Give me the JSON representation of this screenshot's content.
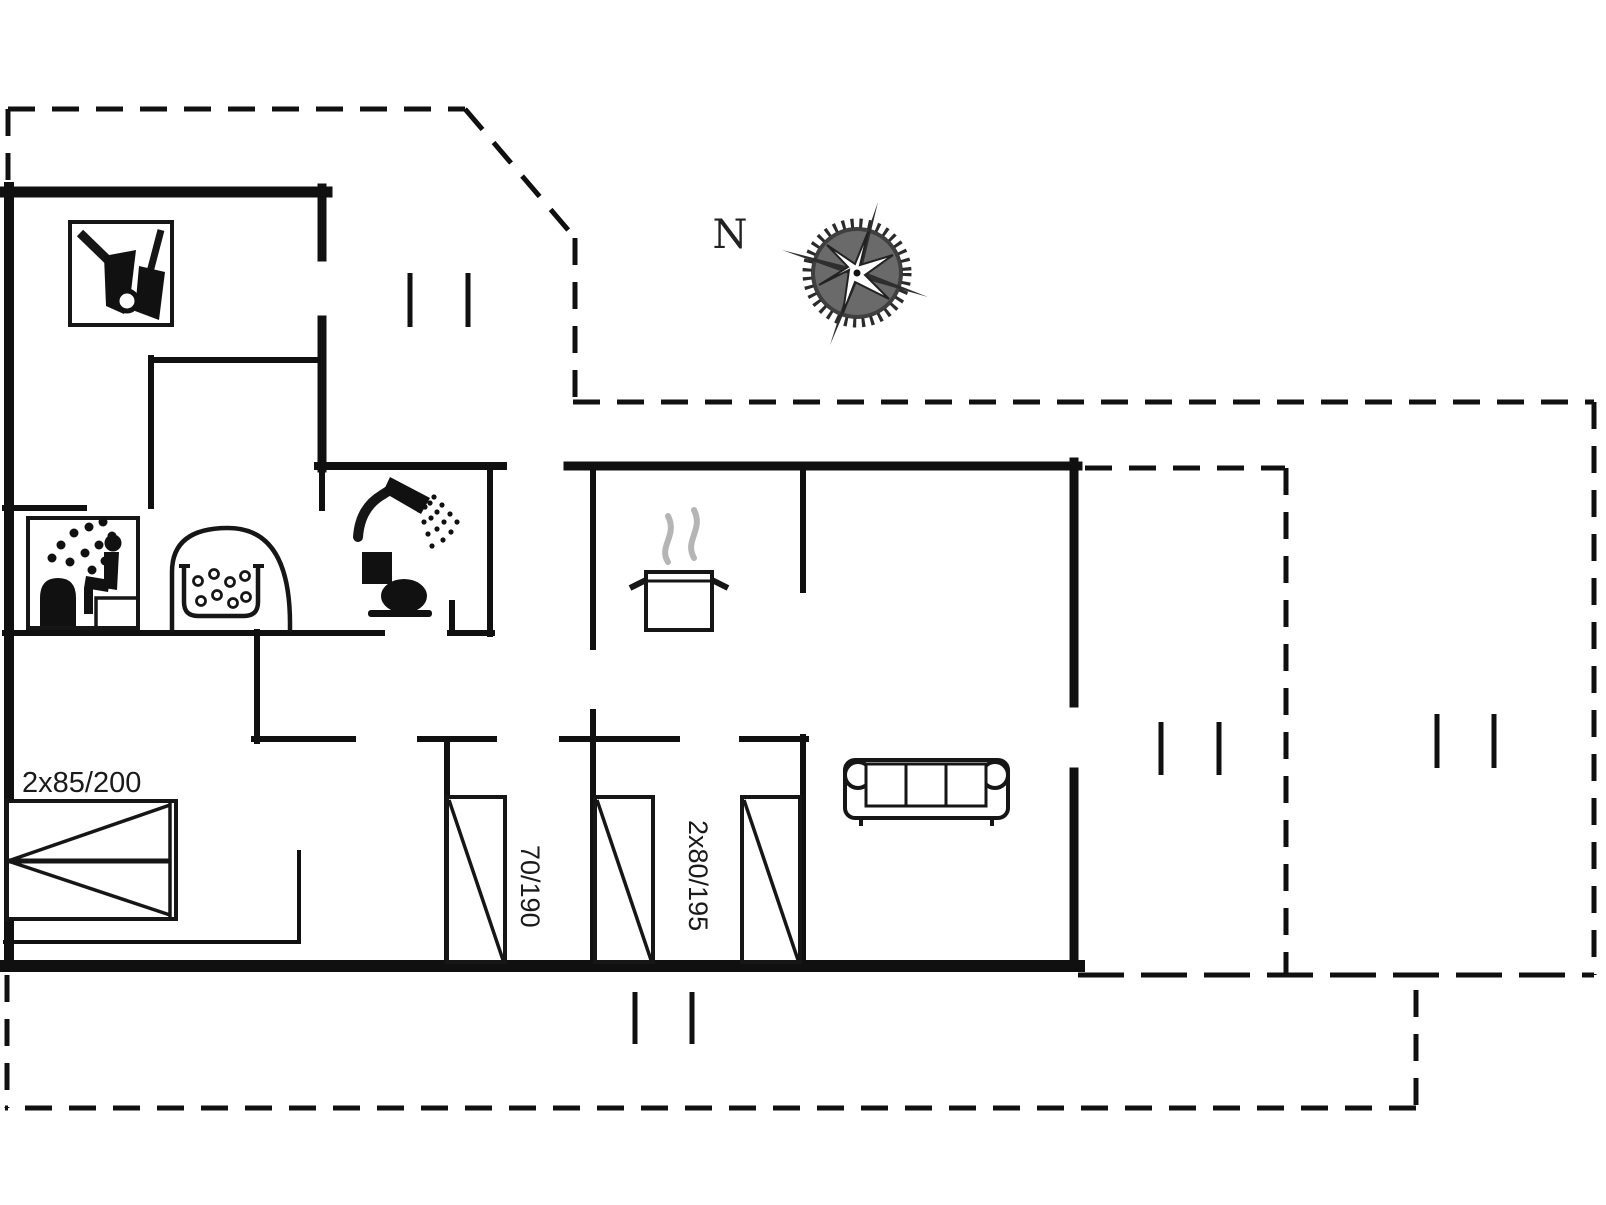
{
  "colors": {
    "line": "#101010",
    "steam": "#b5b5b5",
    "background": "#ffffff"
  },
  "compass": {
    "label": "N"
  },
  "labels": {
    "double_bed": "2x85/200",
    "single_bed": "70/190",
    "twin_beds": "2x80/195"
  },
  "icons": [
    "cleaning-equipment-icon",
    "sauna-icon",
    "whirlpool-tub-icon",
    "shower-icon",
    "toilet-icon",
    "cooking-pot-icon",
    "sofa-icon",
    "double-bed-icon",
    "single-bed-icon",
    "compass-rose-icon",
    "window-mark-icon"
  ]
}
